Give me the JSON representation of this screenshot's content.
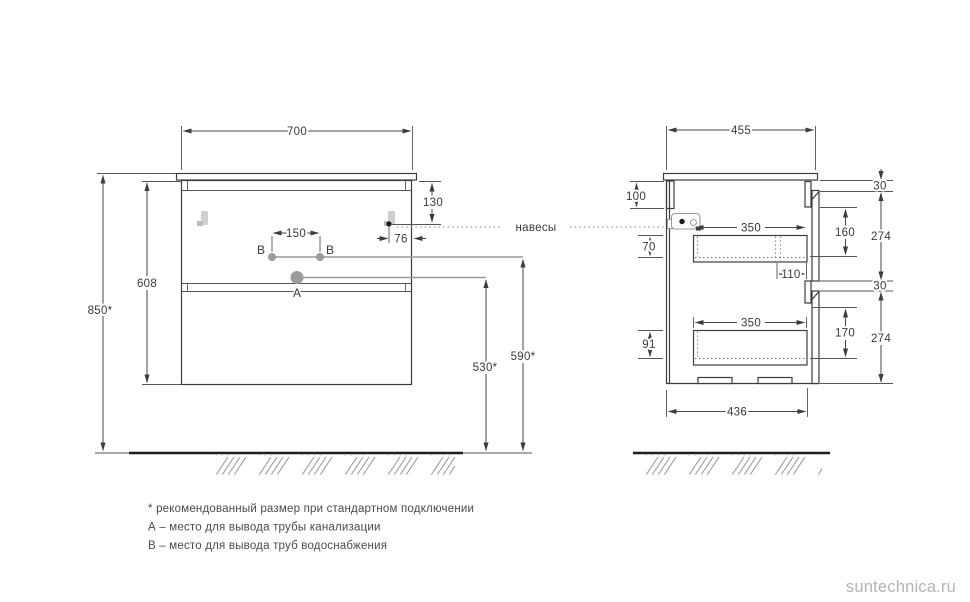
{
  "front_view": {
    "dims": {
      "width": "700",
      "mount_height": "850*",
      "body_height": "608",
      "hanger_top": "130",
      "hanger_side": "76",
      "b_spacing": "150",
      "a_height": "530*",
      "b_height": "590*"
    },
    "points": {
      "a": "A",
      "b_left": "B",
      "b_right": "B"
    }
  },
  "side_view": {
    "dims": {
      "depth": "455",
      "back_rail": "100",
      "gap_top": "30",
      "front1_height": "274",
      "inner1": "160",
      "drawer1_depth": "350",
      "drop1": "70",
      "offset1": "110",
      "gap_mid": "30",
      "front2_height": "274",
      "inner2": "170",
      "drawer2_depth": "350",
      "drop2": "91",
      "bottom_depth": "436"
    }
  },
  "hangers_label": "навесы",
  "footnotes": [
    "* рекомендованный размер при стандартном подключении",
    "А – место для вывода трубы канализации",
    "В – место для вывода труб водоснабжения"
  ],
  "watermark": "suntechnica.ru",
  "colors": {
    "line": "#3d3d3d",
    "reference": "#9a9a9a",
    "watermark": "#b4b4b4"
  }
}
